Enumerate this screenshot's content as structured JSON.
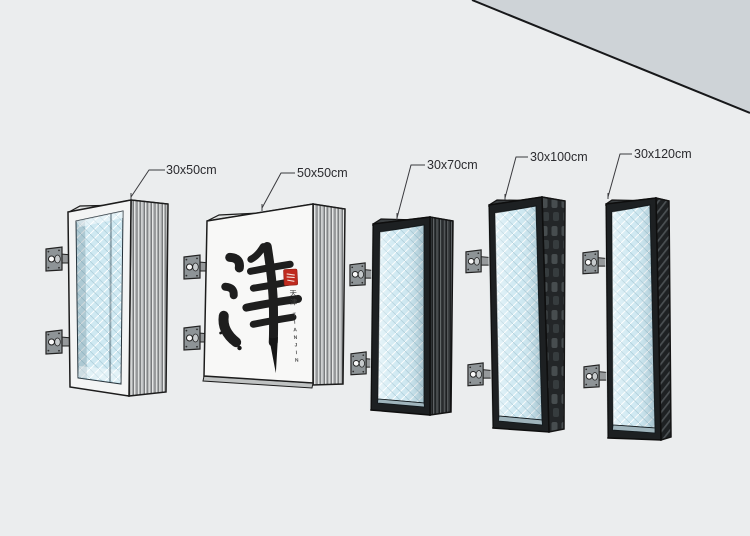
{
  "palette": {
    "wall": "#ebedee",
    "ceiling": "#ced3d7",
    "glass": "#cfe9f2",
    "frame_dark": "#1d2022",
    "frame_light": "#f3f4f4",
    "bracket_gray": "#8e9497",
    "seal_red": "#bf2a1e"
  },
  "annotations": [
    {
      "label": "30x50cm"
    },
    {
      "label": "50x50cm"
    },
    {
      "label": "30x70cm"
    },
    {
      "label": "30x100cm"
    },
    {
      "label": "30x120cm"
    }
  ],
  "artwork": {
    "character": "津",
    "caption_cn": "天津",
    "caption_en": "TIANJIN"
  }
}
